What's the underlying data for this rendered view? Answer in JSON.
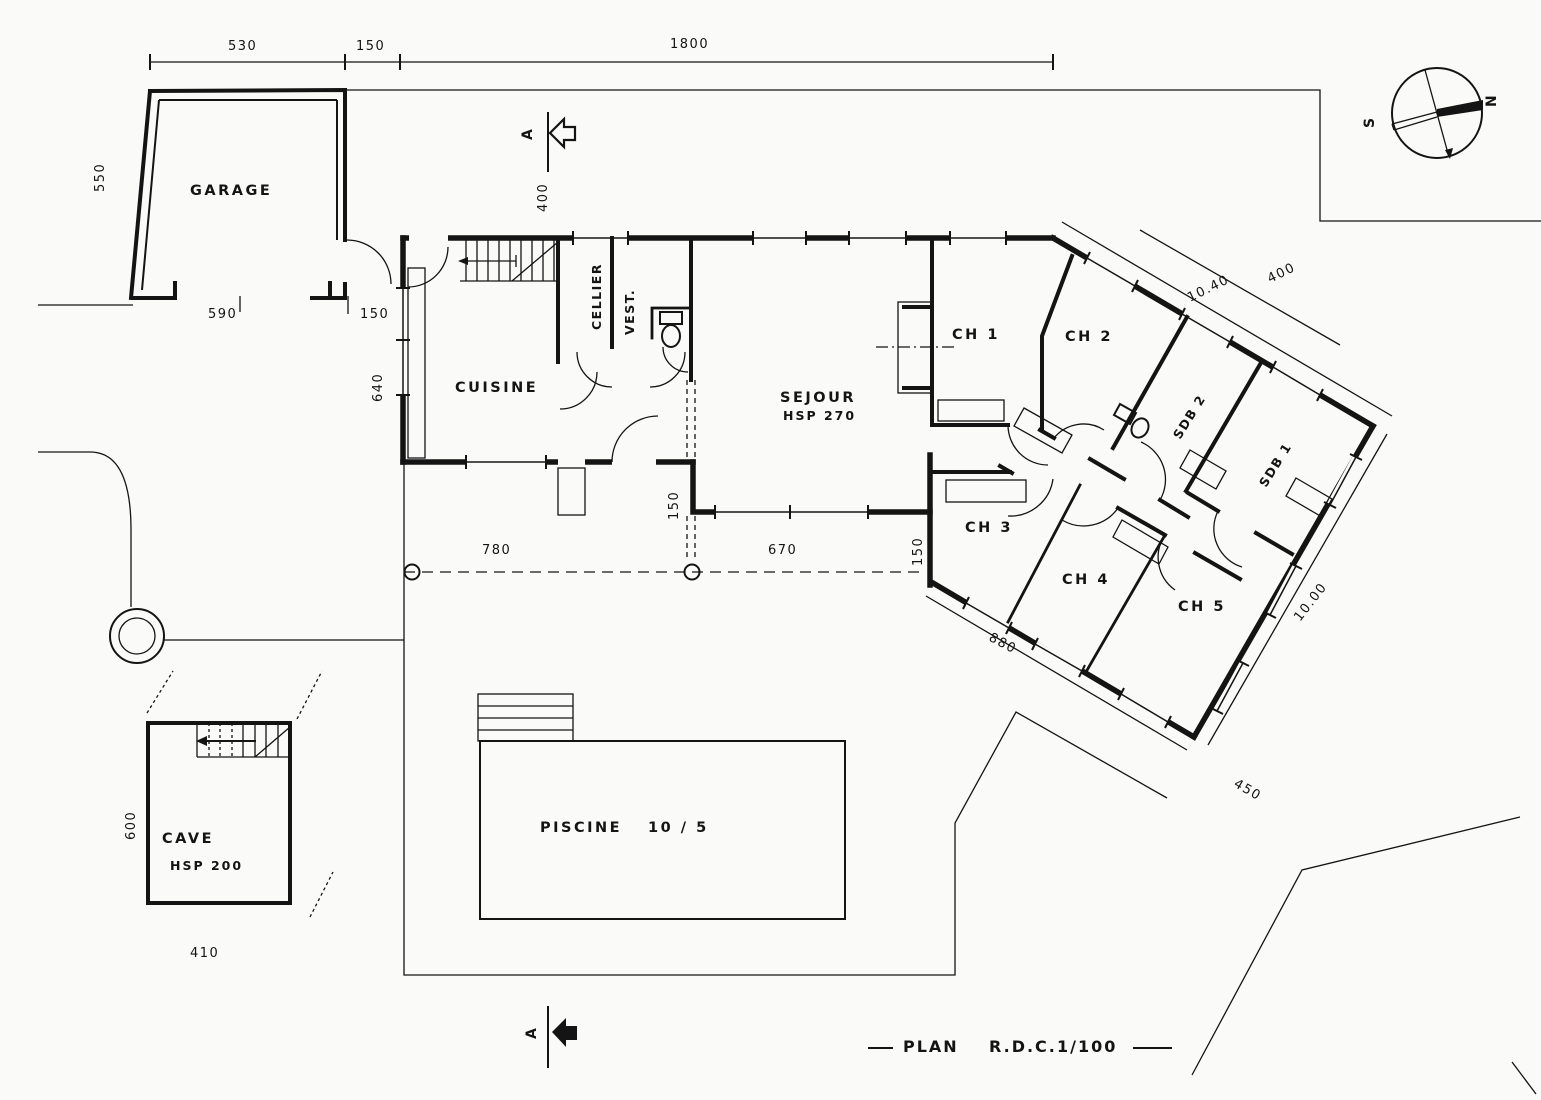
{
  "title": {
    "part1": "PLAN",
    "part2": "R.D.C.",
    "part3": "1/100"
  },
  "compass": {
    "north": "N",
    "south": "S"
  },
  "section_marker": {
    "letter": "A"
  },
  "rooms": {
    "garage": {
      "label": "GARAGE"
    },
    "cuisine": {
      "label": "CUISINE"
    },
    "cellier": {
      "label": "CELLIER"
    },
    "vestibule": {
      "label": "VEST."
    },
    "sejour": {
      "label": "SEJOUR",
      "height": "HSP 270"
    },
    "ch1": {
      "label": "CH 1"
    },
    "ch2": {
      "label": "CH 2"
    },
    "ch3": {
      "label": "CH 3"
    },
    "ch4": {
      "label": "CH 4"
    },
    "ch5": {
      "label": "CH 5"
    },
    "sdb1": {
      "label": "SDB 1"
    },
    "sdb2": {
      "label": "SDB 2"
    },
    "cave": {
      "label": "CAVE",
      "height": "HSP 200"
    },
    "piscine": {
      "label": "PISCINE",
      "size": "10 / 5"
    }
  },
  "dimensions": {
    "garage_width": "530",
    "garage_house_gap": "150",
    "site_width": "1800",
    "garage_depth": "550",
    "garage_door_width": "590",
    "garage_side_gap": "150",
    "house_left": "640",
    "section_offset": "400",
    "terrace_left": "780",
    "terrace_right": "670",
    "step_left": "150",
    "step_right": "150",
    "wing_top": "10.40",
    "wing_top_offset": "400",
    "wing_bottom": "880",
    "wing_end": "10.00",
    "wing_clearance": "450",
    "cave_depth": "600",
    "cave_width": "410"
  }
}
